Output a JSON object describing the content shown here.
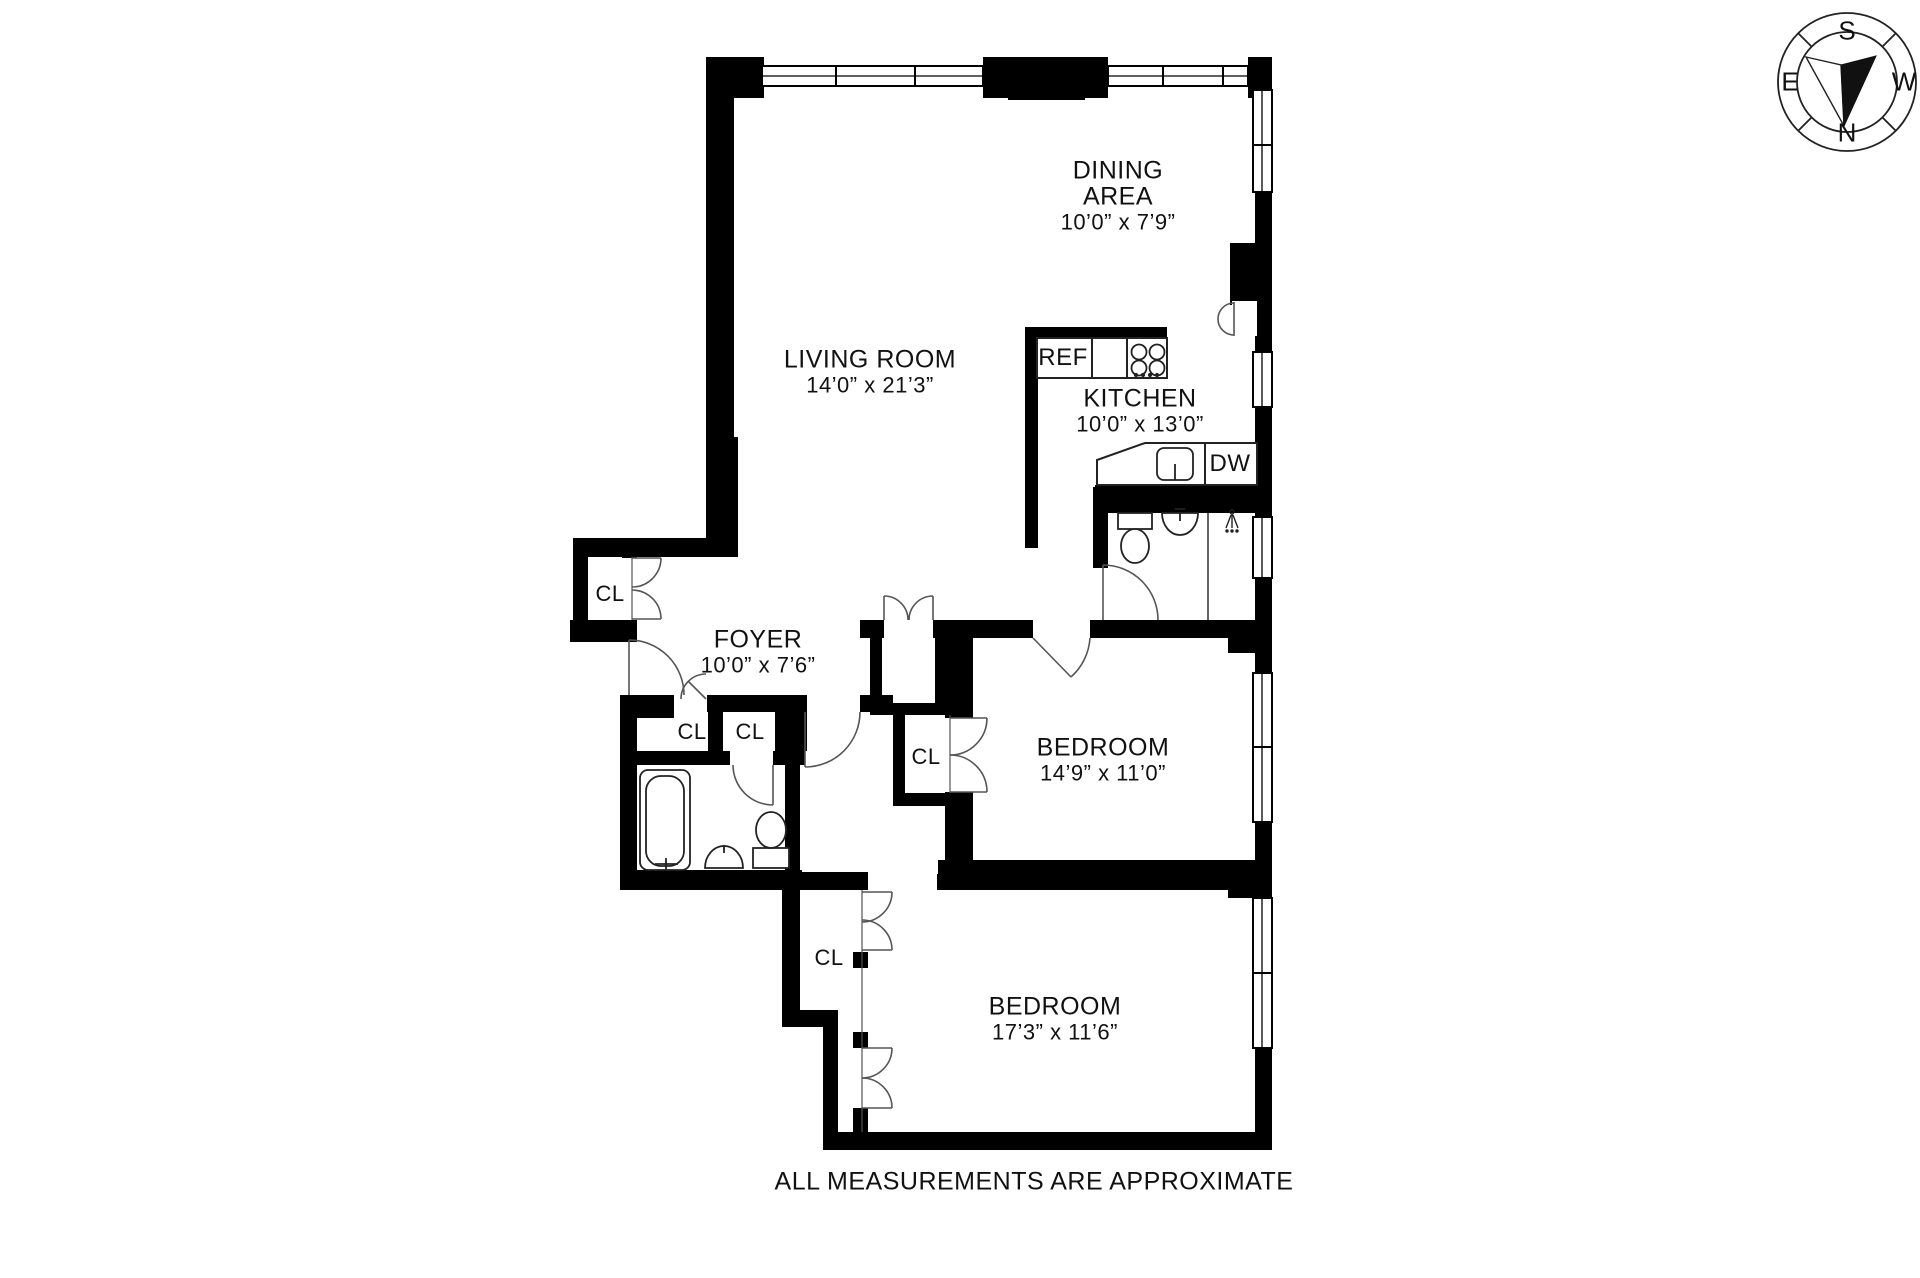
{
  "footer": {
    "text": "ALL MEASUREMENTS ARE APPROXIMATE"
  },
  "compass": {
    "top": "S",
    "right": "W",
    "bottom": "N",
    "left": "E"
  },
  "rooms": [
    {
      "id": "dining-area",
      "name": "DINING AREA",
      "dims": "10’0” x 7’9”"
    },
    {
      "id": "living-room",
      "name": "LIVING ROOM",
      "dims": "14’0” x 21’3”"
    },
    {
      "id": "kitchen",
      "name": "KITCHEN",
      "dims": "10’0” x 13’0”"
    },
    {
      "id": "foyer",
      "name": "FOYER",
      "dims": "10’0” x 7’6”"
    },
    {
      "id": "bedroom-1",
      "name": "BEDROOM",
      "dims": "14’9” x 11’0”"
    },
    {
      "id": "bedroom-2",
      "name": "BEDROOM",
      "dims": "17’3” x 11’6”"
    }
  ],
  "closets": [
    {
      "label": "CL"
    },
    {
      "label": "CL"
    },
    {
      "label": "CL"
    },
    {
      "label": "CL"
    },
    {
      "label": "CL"
    }
  ],
  "appliances": {
    "ref": "REF",
    "dw": "DW"
  },
  "colors": {
    "wall": "#000000",
    "line": "#333333",
    "door": "#555555"
  }
}
